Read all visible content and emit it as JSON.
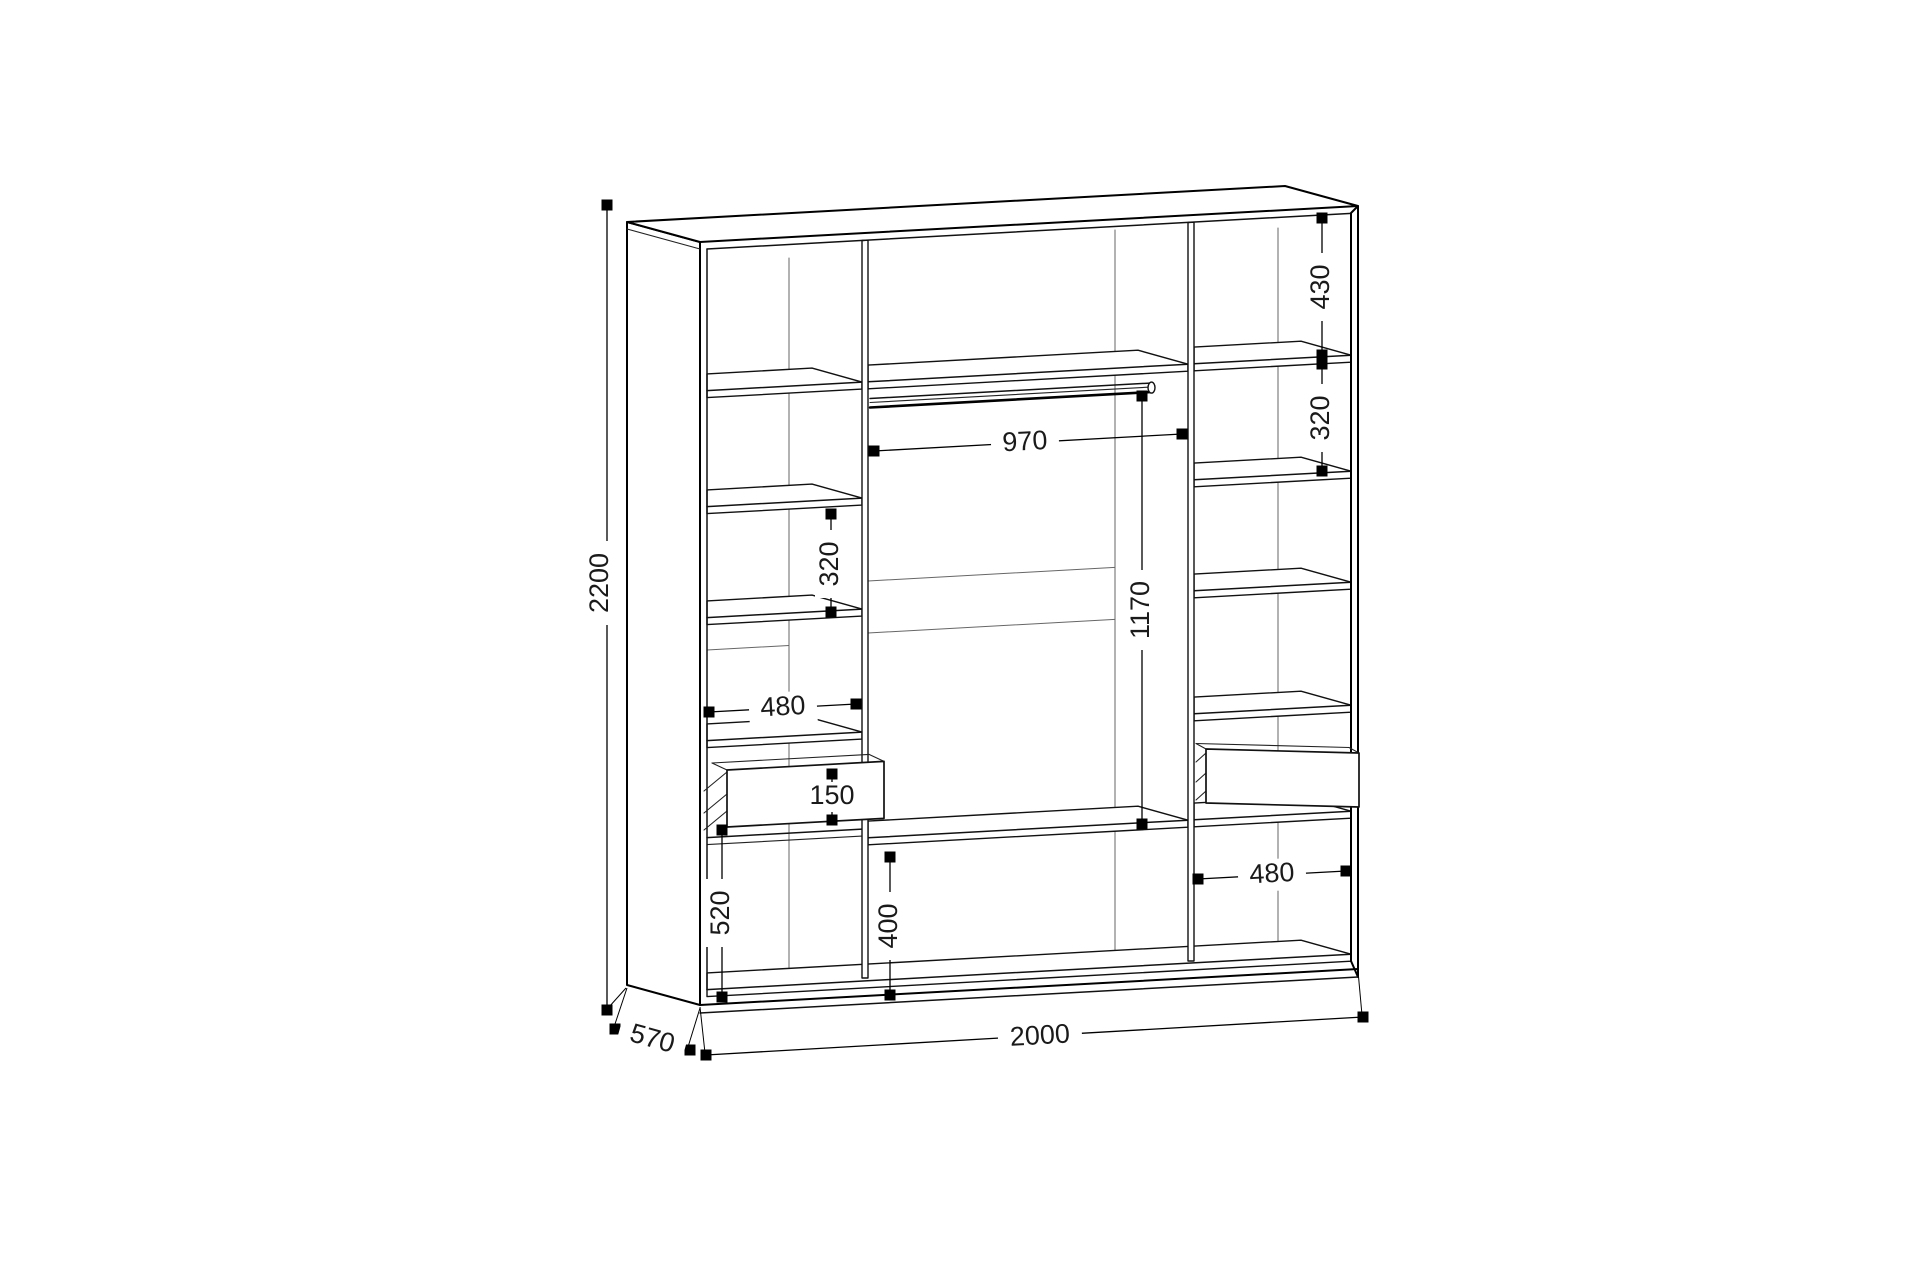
{
  "drawing": {
    "kind": "wardrobe-assembly-technical-drawing",
    "units": "mm",
    "background_color": "#ffffff",
    "line_color": "#000000",
    "dims": {
      "overall_height": "2200",
      "overall_width": "2000",
      "overall_depth": "570",
      "rod_length": "970",
      "rod_to_shelf_height": "1170",
      "right_top_section": "430",
      "right_shelf_spacing": "320",
      "left_shelf_spacing": "320",
      "left_section_width": "480",
      "drawer_front_height": "150",
      "left_bottom_section": "520",
      "middle_bottom_section": "400",
      "right_section_width": "480"
    }
  }
}
